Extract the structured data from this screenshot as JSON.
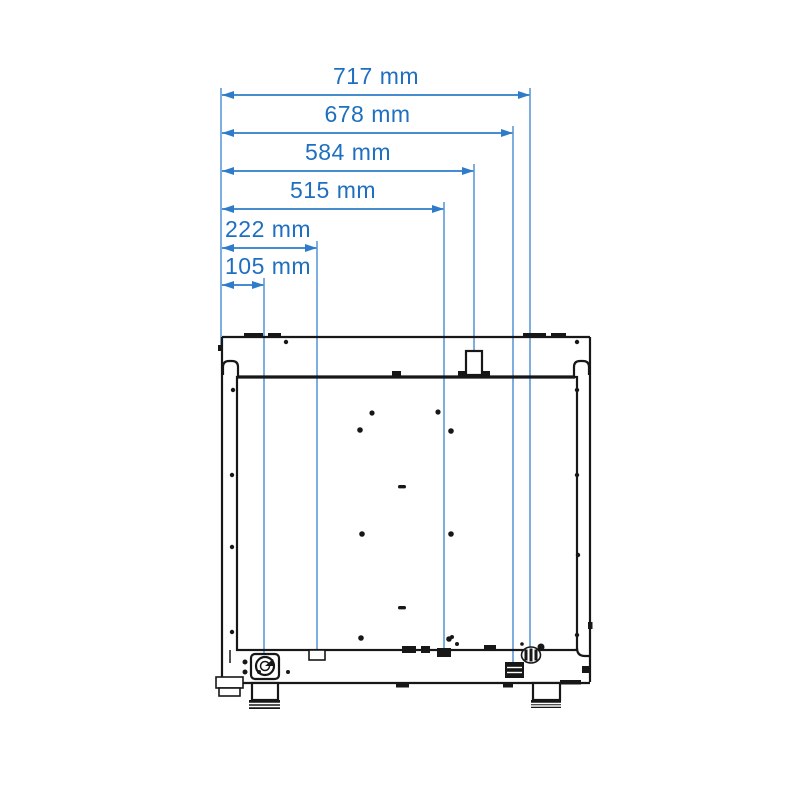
{
  "meta": {
    "description": "Rear-view installation dimension drawing of an appliance (oven) showing connection positions measured from the left edge",
    "units": "mm"
  },
  "colors": {
    "background": "#ffffff",
    "dimension_text_blue": "#1e6fc0",
    "dimension_line_blue": "#2e7cc9",
    "extension_line_blue": "#5b9ad8",
    "ink_black": "#171717"
  },
  "dimensions": [
    {
      "label": "717 mm",
      "value_mm": 717,
      "y": 95,
      "x1": 222,
      "x2": 530,
      "ext_bottom": 656,
      "align": "center"
    },
    {
      "label": "678 mm",
      "value_mm": 678,
      "y": 133,
      "x1": 222,
      "x2": 513,
      "ext_bottom": 666,
      "align": "center"
    },
    {
      "label": "584 mm",
      "value_mm": 584,
      "y": 171,
      "x1": 222,
      "x2": 474,
      "ext_bottom": 352,
      "align": "center"
    },
    {
      "label": "515 mm",
      "value_mm": 515,
      "y": 209,
      "x1": 222,
      "x2": 444,
      "ext_bottom": 652,
      "align": "center"
    },
    {
      "label": "222 mm",
      "value_mm": 222,
      "y": 248,
      "x1": 222,
      "x2": 317,
      "ext_bottom": 655,
      "align": "left"
    },
    {
      "label": "105 mm",
      "value_mm": 105,
      "y": 285,
      "x1": 222,
      "x2": 264,
      "ext_bottom": 662,
      "align": "left"
    }
  ],
  "left_extension": {
    "x": 221,
    "y1": 88,
    "y2": 348
  }
}
